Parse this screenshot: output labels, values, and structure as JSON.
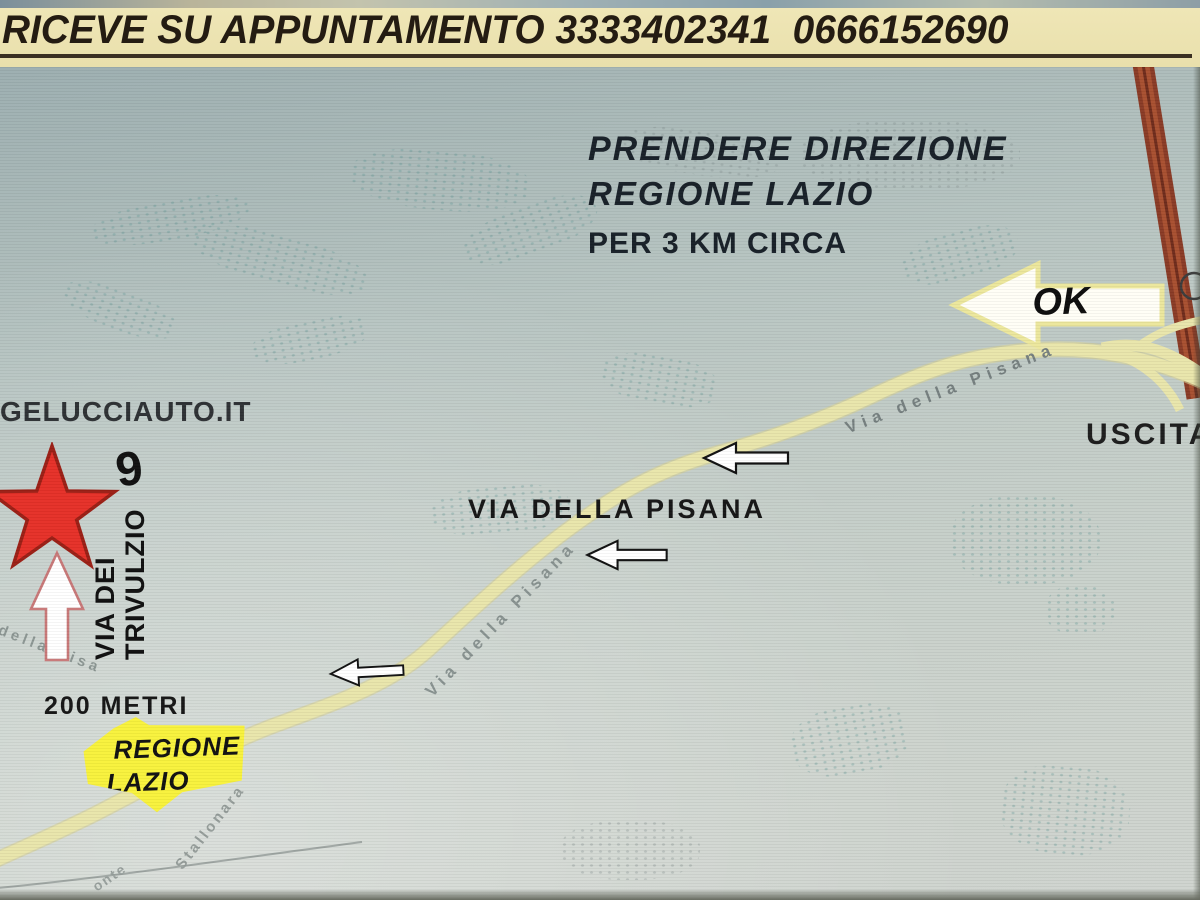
{
  "banner": {
    "text": "RICEVE SU APPUNTAMENTO 3333402341  0666152690",
    "bg_color": "#ece3b2",
    "text_color": "#241c12"
  },
  "directions_note": {
    "line1": "PRENDERE DIREZIONE",
    "line2": "REGIONE LAZIO",
    "line3": "PER 3 KM CIRCA"
  },
  "ok_arrow": {
    "label": "OK"
  },
  "exit": {
    "label": "USCITA"
  },
  "destination": {
    "website": "GELUCCIAUTO.IT",
    "street_line1": "VIA DEI",
    "street_line2": "TRIVULZIO",
    "street_number": "9",
    "distance": "200 METRI"
  },
  "badge": {
    "line1": "REGIONE",
    "line2": "LAZIO",
    "color": "#f8f23c"
  },
  "roads": {
    "main_label": "VIA DELLA PISANA",
    "label_upper": "Via della Pisana",
    "label_middle": "Via della Pisana",
    "label_lower": "della Pisa",
    "label_stallonara": "Stallonara",
    "label_fragment": "onte",
    "surface_color": "#e9e5ab",
    "highway_color": "#8a3b26"
  },
  "marker": {
    "star_color": "#e63028"
  }
}
